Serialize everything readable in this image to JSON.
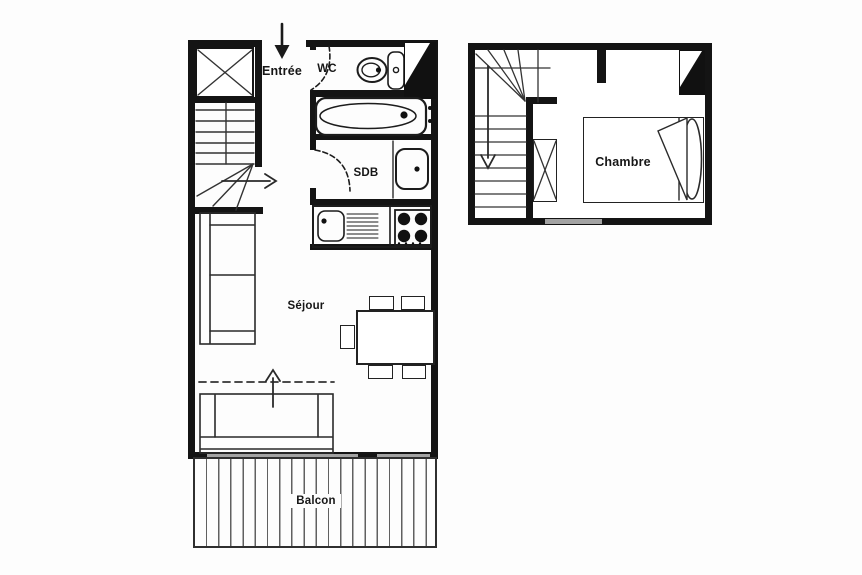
{
  "document": {
    "type": "apartment floor plan",
    "levels": [
      {
        "name": "main level",
        "rooms": [
          "Entrée",
          "WC",
          "SDB",
          "Séjour",
          "Balcon"
        ]
      },
      {
        "name": "upper level",
        "rooms": [
          "Chambre"
        ]
      }
    ]
  },
  "colors": {
    "background": "#fdfdfd",
    "wall": "#141414",
    "linework": "#1c1c1c",
    "window_glass": "#a3a3a3",
    "balcony_deck_line": "#606060"
  },
  "plans": {
    "main": {
      "labels": {
        "entree": "Entrée",
        "wc": "WC",
        "sdb": "SDB",
        "sejour": "Séjour",
        "balcon": "Balcon"
      }
    },
    "upper": {
      "labels": {
        "chambre": "Chambre"
      }
    }
  }
}
